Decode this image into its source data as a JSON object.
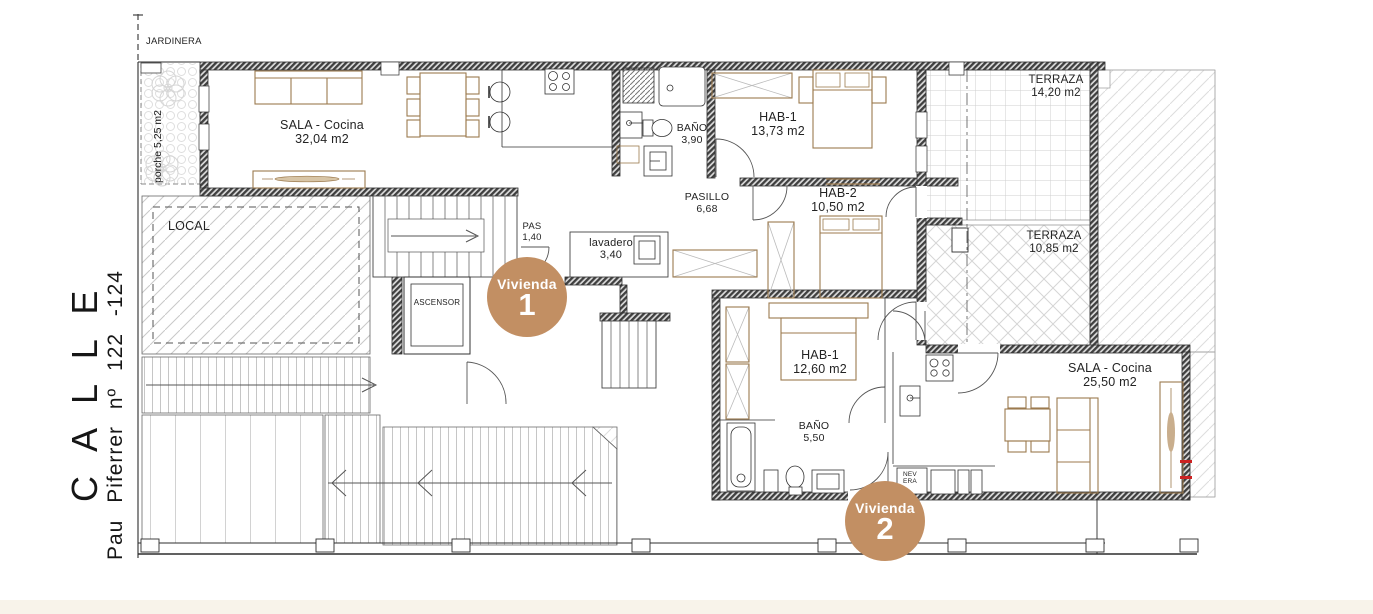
{
  "canvas": {
    "width": 1373,
    "height": 614
  },
  "colors": {
    "badge_bg": "#c28f63",
    "badge_text": "#ffffff",
    "furniture": "#9c7a4e",
    "wall": "#3f3f3f",
    "line": "#2d2d2d",
    "accent_red": "#cc2222",
    "footer_bg": "#f8f3ea"
  },
  "street": {
    "title": "C A L L E",
    "subtitle": "Pau  Piferrer  nº 122 -124"
  },
  "site": {
    "jardinera": "JARDINERA",
    "porche": "porche 5,25 m2",
    "local": "LOCAL",
    "elevator": "ASCENSOR",
    "fridge": {
      "line1": "NEV",
      "line2": "ERA"
    }
  },
  "vivienda1": {
    "badge": {
      "title": "Vivienda",
      "number": "1"
    },
    "sala": {
      "name": "SALA - Cocina",
      "area": "32,04 m2"
    },
    "bano": {
      "name": "BAÑO",
      "area": "3,90"
    },
    "hab1": {
      "name": "HAB-1",
      "area": "13,73 m2"
    },
    "pasillo": {
      "name": "PASILLO",
      "area": "6,68"
    },
    "hab2": {
      "name": "HAB-2",
      "area": "10,50 m2"
    },
    "pas": {
      "name": "PAS",
      "area": "1,40"
    },
    "lavadero": {
      "name": "lavadero",
      "area": "3,40"
    },
    "terraza_upper": {
      "name": "TERRAZA",
      "area": "14,20 m2"
    },
    "terraza_lower": {
      "name": "TERRAZA",
      "area": "10,85 m2"
    }
  },
  "vivienda2": {
    "badge": {
      "title": "Vivienda",
      "number": "2"
    },
    "hab1": {
      "name": "HAB-1",
      "area": "12,60 m2"
    },
    "bano": {
      "name": "BAÑO",
      "area": "5,50"
    },
    "sala": {
      "name": "SALA - Cocina",
      "area": "25,50 m2"
    }
  }
}
